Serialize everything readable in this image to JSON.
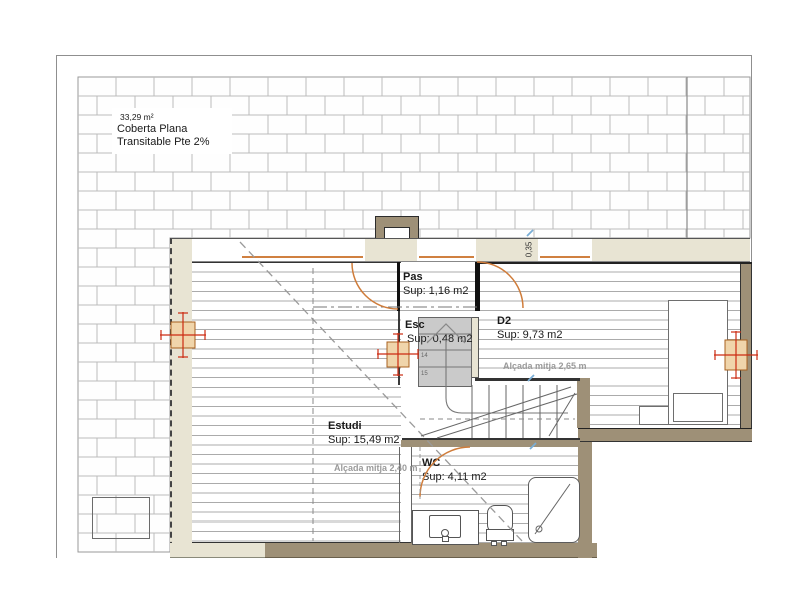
{
  "roof": {
    "area": "33,29 m²",
    "title": "Coberta Plana",
    "subtitle": "Transitable Pte 2%"
  },
  "rooms": {
    "pas": {
      "name": "Pas",
      "area": "Sup: 1,16 m2"
    },
    "esc": {
      "name": "Esc",
      "area": "Sup: 0,48 m2",
      "step_top": "14",
      "step_next": "15"
    },
    "d2": {
      "name": "D2",
      "area": "Sup: 9,73 m2",
      "ceiling_note": "Alçada mitja 2,65 m"
    },
    "estudi": {
      "name": "Estudi",
      "area": "Sup: 15,49 m2",
      "ceiling_note": "Alçada mitja 2,40 m"
    },
    "wc": {
      "name": "WC",
      "area": "Sup: 4,11 m2"
    }
  },
  "dimensions": {
    "parapet_height": "0,35"
  },
  "colors": {
    "wall_light": "#e8e4d3",
    "wall_dark": "#9e9077",
    "door_arc": "#cf7c3a",
    "column_red": "#cc2b12",
    "column_fill": "#f0d5ab",
    "brick_line": "#bcbcbc"
  }
}
